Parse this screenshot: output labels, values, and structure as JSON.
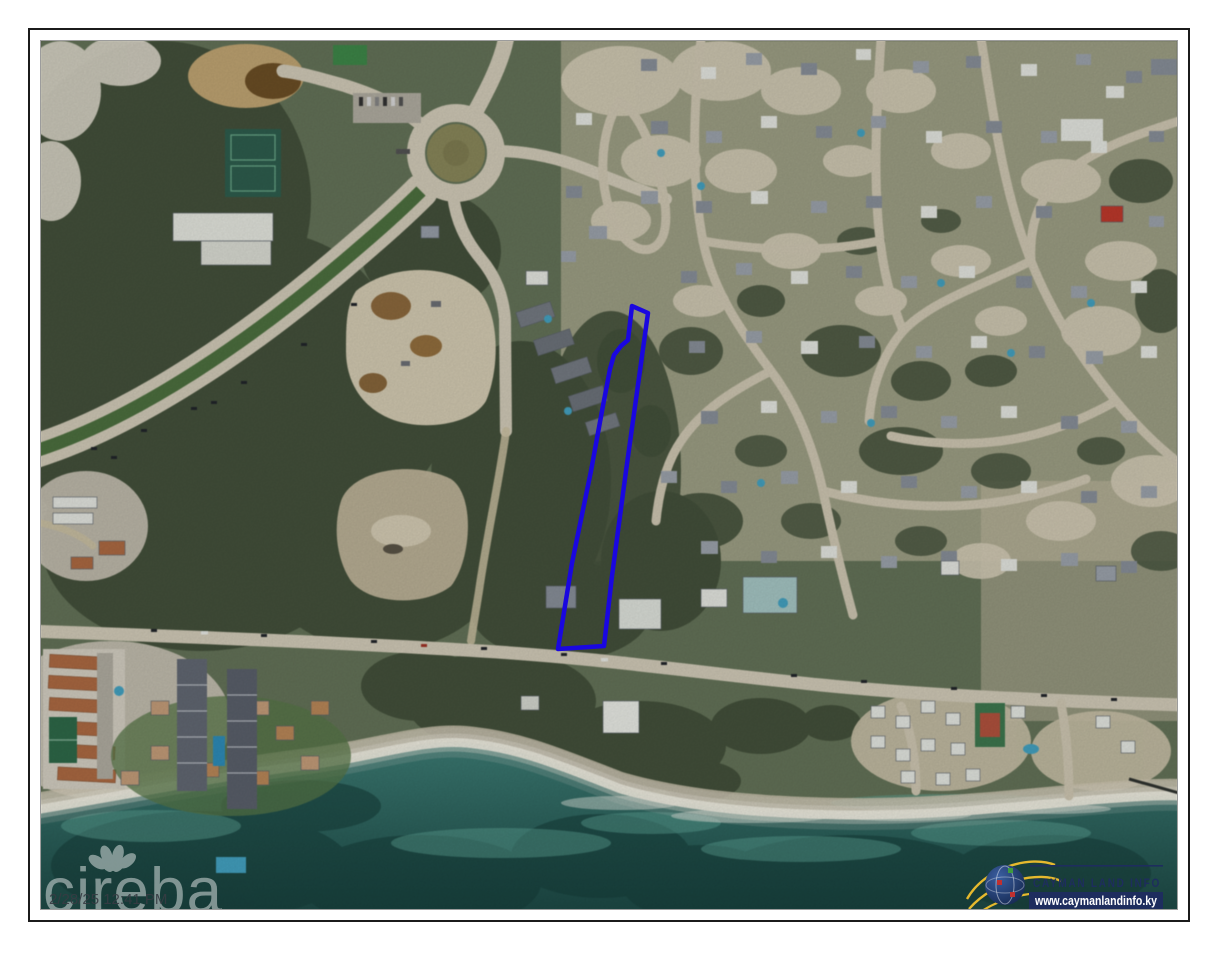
{
  "watermark": {
    "brand": "cireba",
    "timestamp": "2/28/25 12:41 PM"
  },
  "attribution": {
    "name": "CAYMAN LAND INFO",
    "website": "www.caymanlandinfo.ky",
    "navy": "#1e2d5e",
    "gold": "#e6b92e"
  },
  "map": {
    "type": "aerial-satellite-photo",
    "parcel": {
      "outline_color": "#1a07e0",
      "points": "631,305 647,312 625,470 611,575 603,645 557,648 571,562 590,470 601,410 609,368 613,354 620,345 627,339"
    },
    "palette": {
      "ocean_deep": "#1d4a46",
      "ocean_shallow": "#63ad9e",
      "surf": "#f0eee1",
      "vegetation_dark": "#45523c",
      "vegetation_mid": "#5d6b4c",
      "sand": "#d6cdb4",
      "road": "#d6cfbc"
    }
  }
}
